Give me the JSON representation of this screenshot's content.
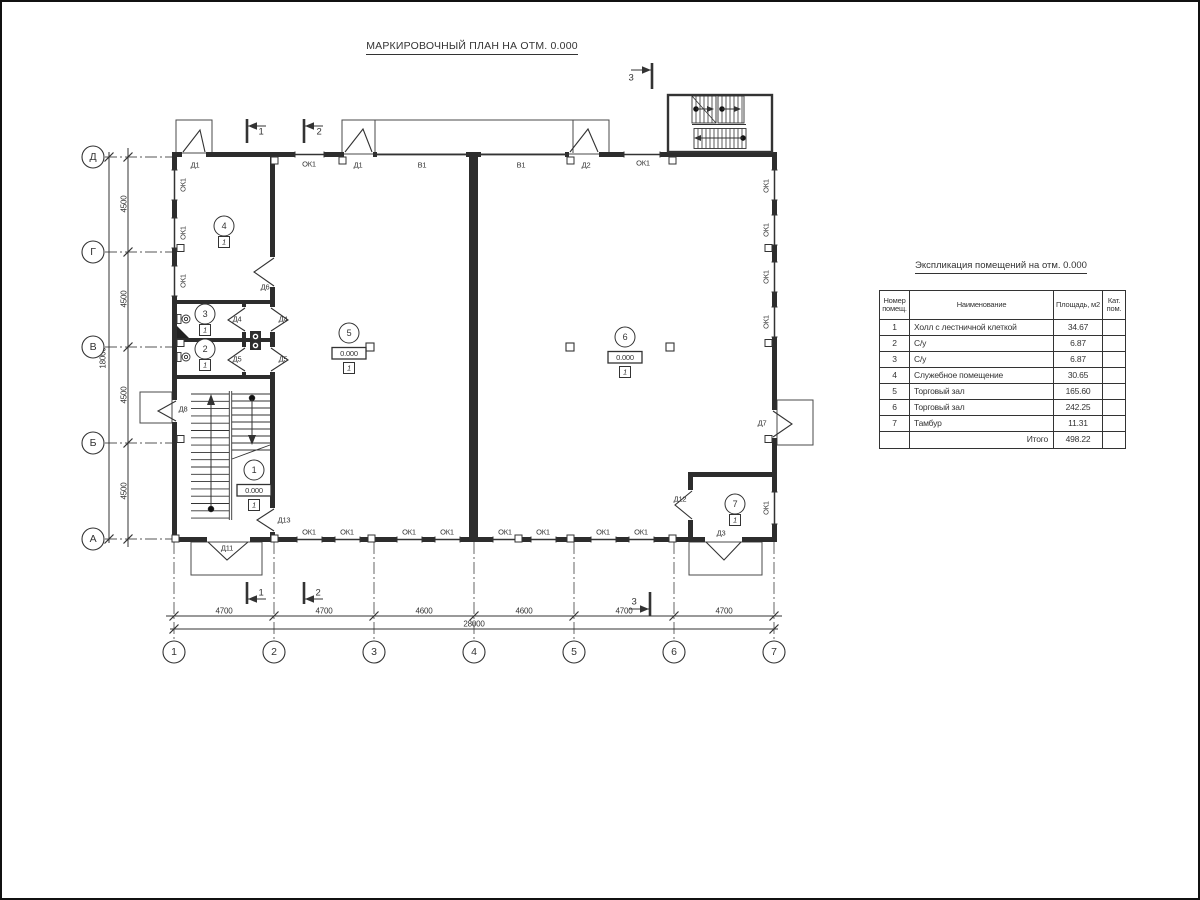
{
  "title": "МАРКИРОВОЧНЫЙ ПЛАН НА ОТМ. 0.000",
  "plan": {
    "elev_value": "0.000",
    "floor_type": "1",
    "axes_left": [
      {
        "label": "Д",
        "y": 155
      },
      {
        "label": "Г",
        "y": 250
      },
      {
        "label": "В",
        "y": 345
      },
      {
        "label": "Б",
        "y": 441
      },
      {
        "label": "А",
        "y": 537
      }
    ],
    "axes_bottom": [
      {
        "label": "1",
        "x": 172
      },
      {
        "label": "2",
        "x": 272
      },
      {
        "label": "3",
        "x": 372
      },
      {
        "label": "4",
        "x": 472
      },
      {
        "label": "5",
        "x": 572
      },
      {
        "label": "6",
        "x": 672
      },
      {
        "label": "7",
        "x": 772
      }
    ],
    "dims": [
      {
        "text": "4500",
        "x": 122,
        "y": 202,
        "rot": true
      },
      {
        "text": "4500",
        "x": 122,
        "y": 297,
        "rot": true
      },
      {
        "text": "4500",
        "x": 122,
        "y": 393,
        "rot": true
      },
      {
        "text": "4500",
        "x": 122,
        "y": 489,
        "rot": true
      },
      {
        "text": "18000",
        "x": 101,
        "y": 356,
        "rot": true
      },
      {
        "text": "4700",
        "x": 222,
        "y": 609
      },
      {
        "text": "4700",
        "x": 322,
        "y": 609
      },
      {
        "text": "4600",
        "x": 422,
        "y": 609
      },
      {
        "text": "4600",
        "x": 522,
        "y": 609
      },
      {
        "text": "4700",
        "x": 622,
        "y": 609
      },
      {
        "text": "4700",
        "x": 722,
        "y": 609
      },
      {
        "text": "28000",
        "x": 472,
        "y": 622
      }
    ],
    "openings": [
      {
        "text": "Д1",
        "x": 193,
        "y": 163
      },
      {
        "text": "ОК1",
        "x": 307,
        "y": 162
      },
      {
        "text": "Д1",
        "x": 356,
        "y": 163
      },
      {
        "text": "В1",
        "x": 420,
        "y": 163
      },
      {
        "text": "В1",
        "x": 519,
        "y": 163
      },
      {
        "text": "Д2",
        "x": 584,
        "y": 163
      },
      {
        "text": "ОК1",
        "x": 641,
        "y": 161
      },
      {
        "text": "ОК1",
        "x": 181,
        "y": 183,
        "rot": true
      },
      {
        "text": "ОК1",
        "x": 181,
        "y": 231,
        "rot": true
      },
      {
        "text": "ОК1",
        "x": 181,
        "y": 279,
        "rot": true
      },
      {
        "text": "ОК1",
        "x": 764,
        "y": 184,
        "rot": true
      },
      {
        "text": "ОК1",
        "x": 764,
        "y": 228,
        "rot": true
      },
      {
        "text": "ОК1",
        "x": 764,
        "y": 275,
        "rot": true
      },
      {
        "text": "ОК1",
        "x": 764,
        "y": 320,
        "rot": true
      },
      {
        "text": "ОК1",
        "x": 764,
        "y": 506,
        "rot": true
      },
      {
        "text": "ОК1",
        "x": 307,
        "y": 530
      },
      {
        "text": "ОК1",
        "x": 345,
        "y": 530
      },
      {
        "text": "ОК1",
        "x": 407,
        "y": 530
      },
      {
        "text": "ОК1",
        "x": 445,
        "y": 530
      },
      {
        "text": "ОК1",
        "x": 503,
        "y": 530
      },
      {
        "text": "ОК1",
        "x": 541,
        "y": 530
      },
      {
        "text": "ОК1",
        "x": 601,
        "y": 530
      },
      {
        "text": "ОК1",
        "x": 639,
        "y": 530
      },
      {
        "text": "Д6",
        "x": 263,
        "y": 285
      },
      {
        "text": "Д4",
        "x": 235,
        "y": 317
      },
      {
        "text": "Д4",
        "x": 281,
        "y": 317
      },
      {
        "text": "Д5",
        "x": 235,
        "y": 357
      },
      {
        "text": "Д5",
        "x": 281,
        "y": 357
      },
      {
        "text": "Д8",
        "x": 181,
        "y": 407
      },
      {
        "text": "Д13",
        "x": 282,
        "y": 518
      },
      {
        "text": "Д11",
        "x": 225,
        "y": 546
      },
      {
        "text": "Д12",
        "x": 678,
        "y": 497
      },
      {
        "text": "Д3",
        "x": 719,
        "y": 531
      },
      {
        "text": "Д7",
        "x": 760,
        "y": 421
      }
    ],
    "rooms": [
      {
        "num": "1",
        "x": 252,
        "y": 468,
        "elev": true
      },
      {
        "num": "2",
        "x": 203,
        "y": 347
      },
      {
        "num": "3",
        "x": 203,
        "y": 312
      },
      {
        "num": "4",
        "x": 222,
        "y": 224
      },
      {
        "num": "5",
        "x": 347,
        "y": 331,
        "elev": true
      },
      {
        "num": "6",
        "x": 623,
        "y": 335,
        "elev": true
      },
      {
        "num": "7",
        "x": 733,
        "y": 502
      }
    ],
    "sections": [
      {
        "num": "1",
        "x": 259,
        "y": 130
      },
      {
        "num": "2",
        "x": 317,
        "y": 130
      },
      {
        "num": "3",
        "x": 629,
        "y": 76
      },
      {
        "num": "1",
        "x": 259,
        "y": 591
      },
      {
        "num": "2",
        "x": 316,
        "y": 591
      },
      {
        "num": "3",
        "x": 632,
        "y": 600
      }
    ]
  },
  "table": {
    "title": "Экспликация помещений на отм. 0.000",
    "headers": {
      "num": "Номер\nпомещ.",
      "name": "Наименование",
      "area": "Площадь,  м2",
      "cat": "Кат.\nпом."
    },
    "rows": [
      {
        "num": "1",
        "name": "Холл с лестничной клеткой",
        "area": "34.67",
        "cat": ""
      },
      {
        "num": "2",
        "name": "С/у",
        "area": "6.87",
        "cat": ""
      },
      {
        "num": "3",
        "name": "С/у",
        "area": "6.87",
        "cat": ""
      },
      {
        "num": "4",
        "name": "Служебное помещение",
        "area": "30.65",
        "cat": ""
      },
      {
        "num": "5",
        "name": "Торговый зал",
        "area": "165.60",
        "cat": ""
      },
      {
        "num": "6",
        "name": "Торговый зал",
        "area": "242.25",
        "cat": ""
      },
      {
        "num": "7",
        "name": "Тамбур",
        "area": "11.31",
        "cat": ""
      }
    ],
    "total_label": "Итого",
    "total_area": "498.22"
  }
}
